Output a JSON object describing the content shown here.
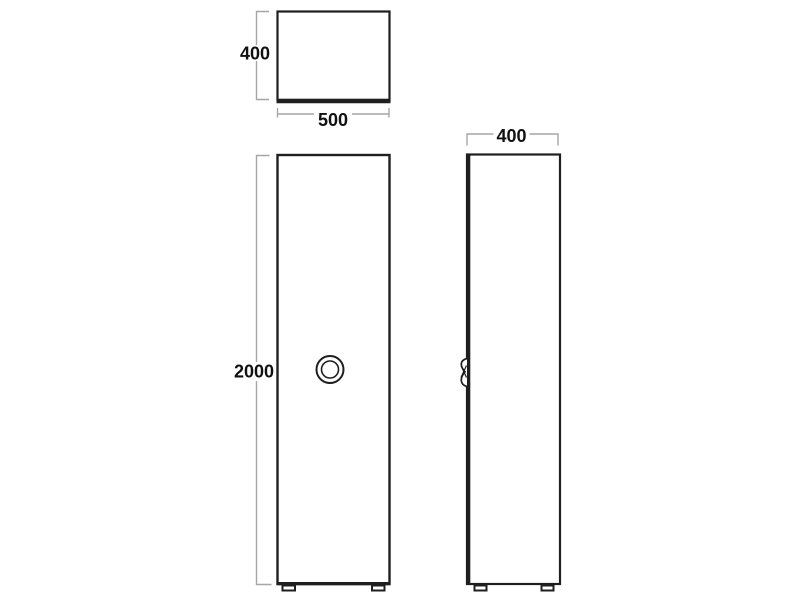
{
  "dimensions": {
    "top_view_height": "400",
    "top_view_width": "500",
    "front_view_height": "2000",
    "side_view_depth": "400"
  },
  "colors": {
    "outline": "#1f1f1f",
    "dimension_line": "#a6a6a6",
    "label_text": "#111111",
    "background": "#ffffff"
  }
}
